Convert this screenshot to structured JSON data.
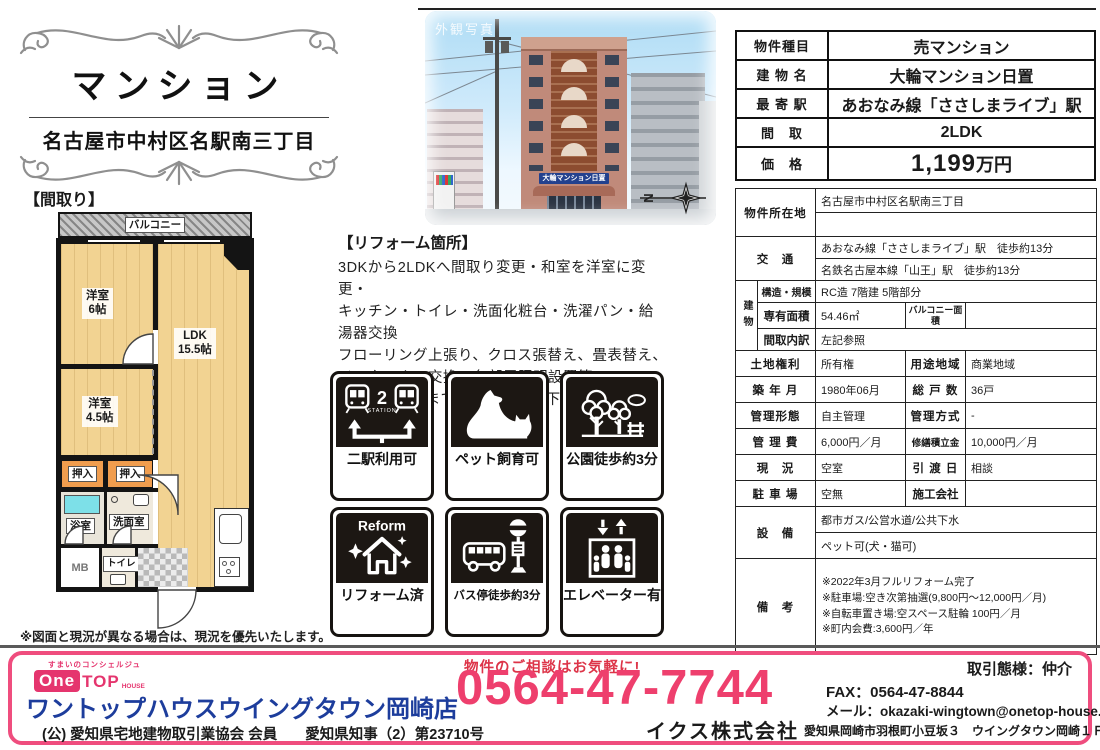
{
  "title_block": {
    "title": "マンション",
    "address": "名古屋市中村区名駅南三丁目"
  },
  "photo": {
    "watermark": "外観写真",
    "sign": "大輪マンション日置"
  },
  "floorplan": {
    "section_label": "【間取り】",
    "compass_n": "N",
    "balcony": "バルコニー",
    "room1_name": "洋室",
    "room1_size": "6帖",
    "ldk_name": "LDK",
    "ldk_size": "15.5帖",
    "room2_name": "洋室",
    "room2_size": "4.5帖",
    "closet1": "押入",
    "closet2": "押入",
    "bath": "浴室",
    "wash": "洗面室",
    "mb": "MB",
    "toilet": "トイレ",
    "note": "※図面と現況が異なる場合は、現況を優先いたします。"
  },
  "reform": {
    "heading": "【リフォーム箇所】",
    "line1": "3DKから2LDKへ間取り変更・和室を洋室に変更・",
    "line2": "キッチン・トイレ・洗面化粧台・洗濯パン・給湯器交換",
    "line3": "フローリング上張り、クロス張替え、畳表替え、",
    "line4": "インターホン交換、各部屋照明設置等",
    "line5": "※詳細は担当までお問い合わせ下さい。"
  },
  "badges": [
    {
      "label": "二駅利用可",
      "icon": "two-stations-icon",
      "station_count": "2",
      "station_text": "STATION"
    },
    {
      "label": "ペット飼育可",
      "icon": "pets-allowed-icon"
    },
    {
      "label": "公園徒歩約3分",
      "icon": "park-walk-icon"
    },
    {
      "label": "リフォーム済",
      "icon": "reform-done-icon",
      "reform_text": "Reform"
    },
    {
      "label": "バス停徒歩約3分",
      "icon": "bus-stop-icon"
    },
    {
      "label": "エレベーター有",
      "icon": "elevator-icon"
    }
  ],
  "summary": {
    "rows": [
      {
        "label": "物件種目",
        "value": "売マンション"
      },
      {
        "label": "建 物 名",
        "value": "大輪マンション日置"
      },
      {
        "label": "最 寄 駅",
        "value": "あおなみ線「ささしまライブ」駅"
      },
      {
        "label": "間　取",
        "value": "2LDK"
      },
      {
        "label": "価　格",
        "value": "1,199",
        "value_unit": "万円"
      }
    ]
  },
  "detail": {
    "location_label": "物件所在地",
    "location_line1": "名古屋市中村区名駅南三丁目",
    "location_line2": "",
    "access_label": "交　通",
    "access_line1": "あおなみ線「ささしまライブ」駅　徒歩約13分",
    "access_line2": "名鉄名古屋本線「山王」駅　徒歩約13分",
    "building_label": "建物",
    "structure_label": "構造・規模",
    "structure_value": "RC造 7階建 5階部分",
    "area_label": "専有面積",
    "area_value": "54.46㎡",
    "balcony_area_label": "バルコニー面積",
    "balcony_area_value": "",
    "layout_label": "間取内訳",
    "layout_value": "左記参照",
    "land_label": "土地権利",
    "land_value": "所有権",
    "zone_label": "用途地域",
    "zone_value": "商業地域",
    "built_label": "築 年 月",
    "built_value": "1980年06月",
    "units_label": "総 戸 数",
    "units_value": "36戸",
    "mgmt_form_label": "管理形態",
    "mgmt_form_value": "自主管理",
    "mgmt_method_label": "管理方式",
    "mgmt_method_value": "-",
    "mgmt_fee_label": "管 理 費",
    "mgmt_fee_value": "6,000円／月",
    "repair_label": "修繕積立金",
    "repair_value": "10,000円／月",
    "status_label": "現　況",
    "status_value": "空室",
    "handover_label": "引 渡 日",
    "handover_value": "相談",
    "parking_label": "駐 車 場",
    "parking_value": "空無",
    "builder_label": "施工会社",
    "builder_value": "",
    "equip_label": "設　備",
    "equip_line1": "都市ガス/公営水道/公共下水",
    "equip_line2": "ペット可(犬・猫可)",
    "remarks_label": "備　考",
    "remarks_line1": "※2022年3月フルリフォーム完了",
    "remarks_line2": "※駐車場:空き次第抽選(9,800円～12,000円／月)",
    "remarks_line3": "※自転車置き場:空スペース駐輪 100円／月",
    "remarks_line4": "※町内会費:3,600円／年"
  },
  "footer": {
    "logo_tagline": "すまいのコンシェルジュ",
    "logo_one": "One",
    "logo_top": "TOP",
    "logo_house": "HOUSE",
    "company_name": "ワントップハウスウイングタウン岡崎店",
    "contact_lead": "物件のご相談はお気軽に!",
    "phone": "0564-47-7744",
    "deal_type": "取引態様：仲介",
    "fax": "FAX：0564-47-8844",
    "email": "メール：okazaki-wingtown@onetop-house.jp",
    "association": "(公) 愛知県宅地建物取引業協会 会員",
    "license": "愛知県知事（2）第23710号",
    "corp_name": "イクス株式会社",
    "corp_address": "愛知県岡崎市羽根町小豆坂３　ウイングタウン岡崎１Ｆ"
  },
  "colors": {
    "pink": "#ee3f6d",
    "navy": "#1d3d9c",
    "red": "#dd3448",
    "badge_black": "#1c1713",
    "wood": "#f2d392"
  }
}
